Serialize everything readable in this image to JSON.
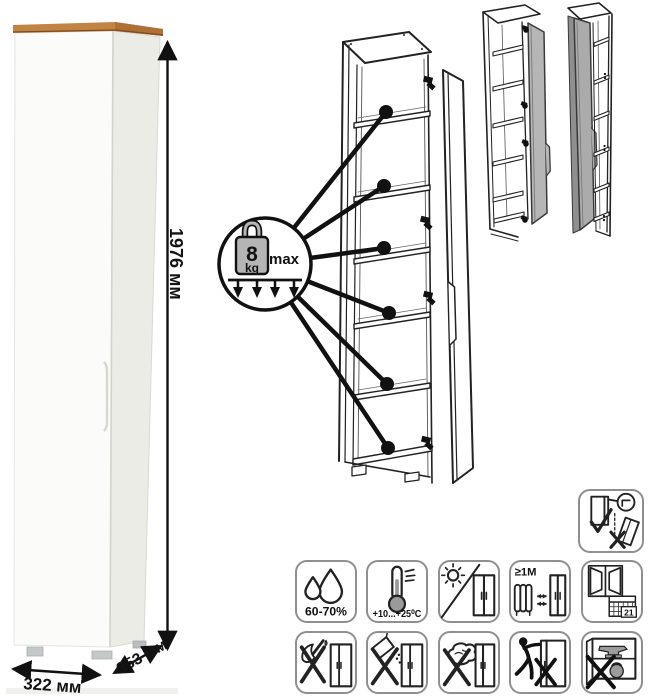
{
  "dimensions": {
    "height": "1976 мм",
    "width": "322 мм",
    "depth": "353 мм"
  },
  "shelf_load": {
    "value": "8",
    "unit": "kg",
    "max_label": "max"
  },
  "care_icons": {
    "humidity": "60-70%",
    "temperature": "+10...+25⁰C",
    "min_distance": "≥1M",
    "acclimatization_days": "21"
  },
  "colors": {
    "wood_top": "#bf8142",
    "door_gray": "#b3b3b3",
    "line": "#1c1c1c",
    "icon_border": "#8f8f8f"
  }
}
